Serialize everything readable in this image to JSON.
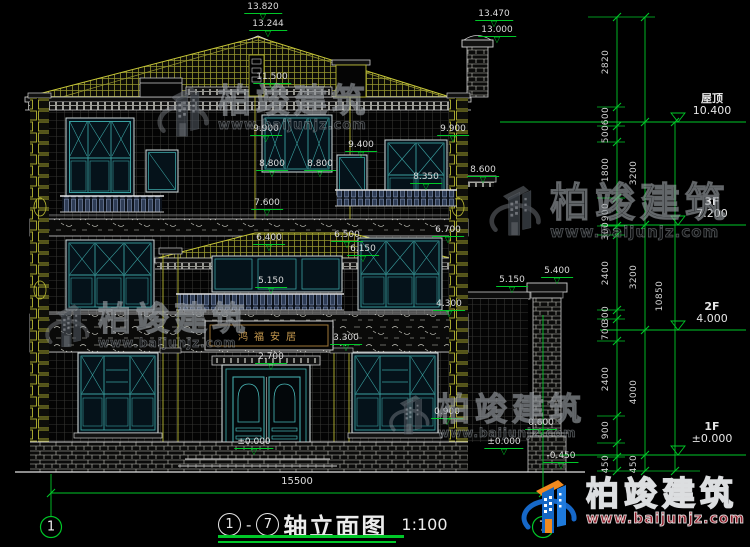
{
  "brand": {
    "name": "柏竣建筑",
    "url": "www.baijunjz.com"
  },
  "glyphs": {
    "level_triangle": "▽"
  },
  "title_block": {
    "axis_start": "1",
    "dash": "-",
    "axis_end": "7",
    "name": "轴立面图",
    "scale": "1:100"
  },
  "plaque": {
    "text": "鸿福安居"
  },
  "bottom_dim": {
    "text": "15500"
  },
  "axes": [
    {
      "n": "1",
      "x": 51,
      "y": 527
    },
    {
      "n": "7",
      "x": 543,
      "y": 527
    }
  ],
  "levels_right": [
    {
      "name": "屋顶",
      "value": "10.400",
      "x": 712,
      "y": 93
    },
    {
      "name": "3F",
      "value": "7.200",
      "x": 712,
      "y": 196
    },
    {
      "name": "2F",
      "value": "4.000",
      "x": 712,
      "y": 301
    },
    {
      "name": "1F",
      "value": "±0.000",
      "x": 712,
      "y": 421
    }
  ],
  "annotations": {
    "elevation_flags": [
      {
        "t": "13.820",
        "x": 263,
        "y": 3
      },
      {
        "t": "13.244",
        "x": 268,
        "y": 20
      },
      {
        "t": "13.470",
        "x": 494,
        "y": 10
      },
      {
        "t": "13.000",
        "x": 497,
        "y": 26
      },
      {
        "t": "11.500",
        "x": 272,
        "y": 73
      },
      {
        "t": "9.900",
        "x": 266,
        "y": 125
      },
      {
        "t": "9.900",
        "x": 453,
        "y": 125
      },
      {
        "t": "9.400",
        "x": 361,
        "y": 141
      },
      {
        "t": "8.800",
        "x": 272,
        "y": 160
      },
      {
        "t": "8.800",
        "x": 320,
        "y": 160
      },
      {
        "t": "8.350",
        "x": 426,
        "y": 173
      },
      {
        "t": "8.600",
        "x": 483,
        "y": 166
      },
      {
        "t": "7.600",
        "x": 267,
        "y": 199
      },
      {
        "t": "6.700",
        "x": 448,
        "y": 226
      },
      {
        "t": "6.400",
        "x": 269,
        "y": 234
      },
      {
        "t": "6.500",
        "x": 347,
        "y": 231
      },
      {
        "t": "6.150",
        "x": 363,
        "y": 245
      },
      {
        "t": "5.400",
        "x": 557,
        "y": 267
      },
      {
        "t": "5.150",
        "x": 512,
        "y": 276
      },
      {
        "t": "5.150",
        "x": 271,
        "y": 277
      },
      {
        "t": "4.300",
        "x": 449,
        "y": 300
      },
      {
        "t": "3.300",
        "x": 346,
        "y": 334
      },
      {
        "t": "2.700",
        "x": 271,
        "y": 353
      },
      {
        "t": "0.900",
        "x": 447,
        "y": 408
      },
      {
        "t": "±0.000",
        "x": 254,
        "y": 438
      },
      {
        "t": "±0.000",
        "x": 504,
        "y": 438
      },
      {
        "t": "0.600",
        "x": 541,
        "y": 419
      },
      {
        "t": "-0.450",
        "x": 561,
        "y": 452
      }
    ],
    "vertical_dims": [
      {
        "t": "2820",
        "x": 606,
        "y": 62
      },
      {
        "t": "600",
        "x": 606,
        "y": 116
      },
      {
        "t": "500",
        "x": 606,
        "y": 134
      },
      {
        "t": "1800",
        "x": 606,
        "y": 170
      },
      {
        "t": "900",
        "x": 606,
        "y": 212
      },
      {
        "t": "300",
        "x": 606,
        "y": 231
      },
      {
        "t": "2400",
        "x": 606,
        "y": 273
      },
      {
        "t": "300",
        "x": 606,
        "y": 315
      },
      {
        "t": "700",
        "x": 606,
        "y": 331
      },
      {
        "t": "2400",
        "x": 606,
        "y": 379
      },
      {
        "t": "900",
        "x": 606,
        "y": 430
      },
      {
        "t": "450",
        "x": 606,
        "y": 464
      },
      {
        "t": "3200",
        "x": 634,
        "y": 173
      },
      {
        "t": "3200",
        "x": 634,
        "y": 277
      },
      {
        "t": "4000",
        "x": 634,
        "y": 392
      },
      {
        "t": "450",
        "x": 634,
        "y": 464
      },
      {
        "t": "10850",
        "x": 660,
        "y": 296
      }
    ]
  },
  "watermarks": [
    {
      "variant": "gray",
      "x": 156,
      "y": 84,
      "logo": 56,
      "chars_size": 33,
      "url_size": 13
    },
    {
      "variant": "gray",
      "x": 44,
      "y": 302,
      "logo": 48,
      "chars_size": 33,
      "url_size": 12
    },
    {
      "variant": "gray",
      "x": 488,
      "y": 183,
      "logo": 56,
      "chars_size": 40,
      "url_size": 15
    },
    {
      "variant": "gray",
      "x": 388,
      "y": 393,
      "logo": 44,
      "chars_size": 32,
      "url_size": 12
    },
    {
      "variant": "color",
      "x": 520,
      "y": 477,
      "logo": 60,
      "chars_size": 33,
      "url_size": 14
    }
  ],
  "colors": {
    "dimension_green": "#00c828",
    "roof_yellow": "#a8a830",
    "window_teal": "#3aa0a0",
    "text_white": "#dcdcdc",
    "logo_blue": "#1467c4",
    "logo_orange": "#f28a1e"
  }
}
